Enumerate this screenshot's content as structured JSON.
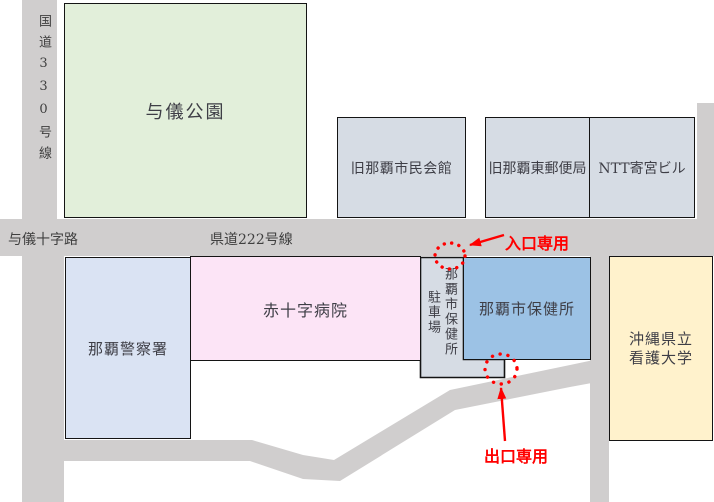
{
  "map": {
    "roads": {
      "route330_label": "国道330号線",
      "yogi_crossroads_label": "与儀十字路",
      "route222_label": "県道222号線"
    },
    "buildings": {
      "yogi_park": "与儀公園",
      "civic_hall": "旧那覇市民会館",
      "post_office": "旧那覇東郵便局",
      "ntt_building": "NTT寄宮ビル",
      "police_station": "那覇警察署",
      "red_cross_hospital": "赤十字病院",
      "health_center": "那覇市保健所",
      "parking_main": "那覇市保健所",
      "parking_sub": "駐車場",
      "nursing_university_line1": "沖縄県立",
      "nursing_university_line2": "看護大学"
    },
    "annotations": {
      "entrance_only": "入口専用",
      "exit_only": "出口専用"
    },
    "colors": {
      "park_green": "#e2efda",
      "building_gray_blue": "#d6dce4",
      "police_lavender": "#dae3f3",
      "hospital_pink": "#fce4f6",
      "health_center_blue": "#9cc2e5",
      "university_yellow": "#fff2cc",
      "road_gray": "#d0cece",
      "outline_black": "#141414",
      "annotation_red": "#ff0000"
    }
  }
}
